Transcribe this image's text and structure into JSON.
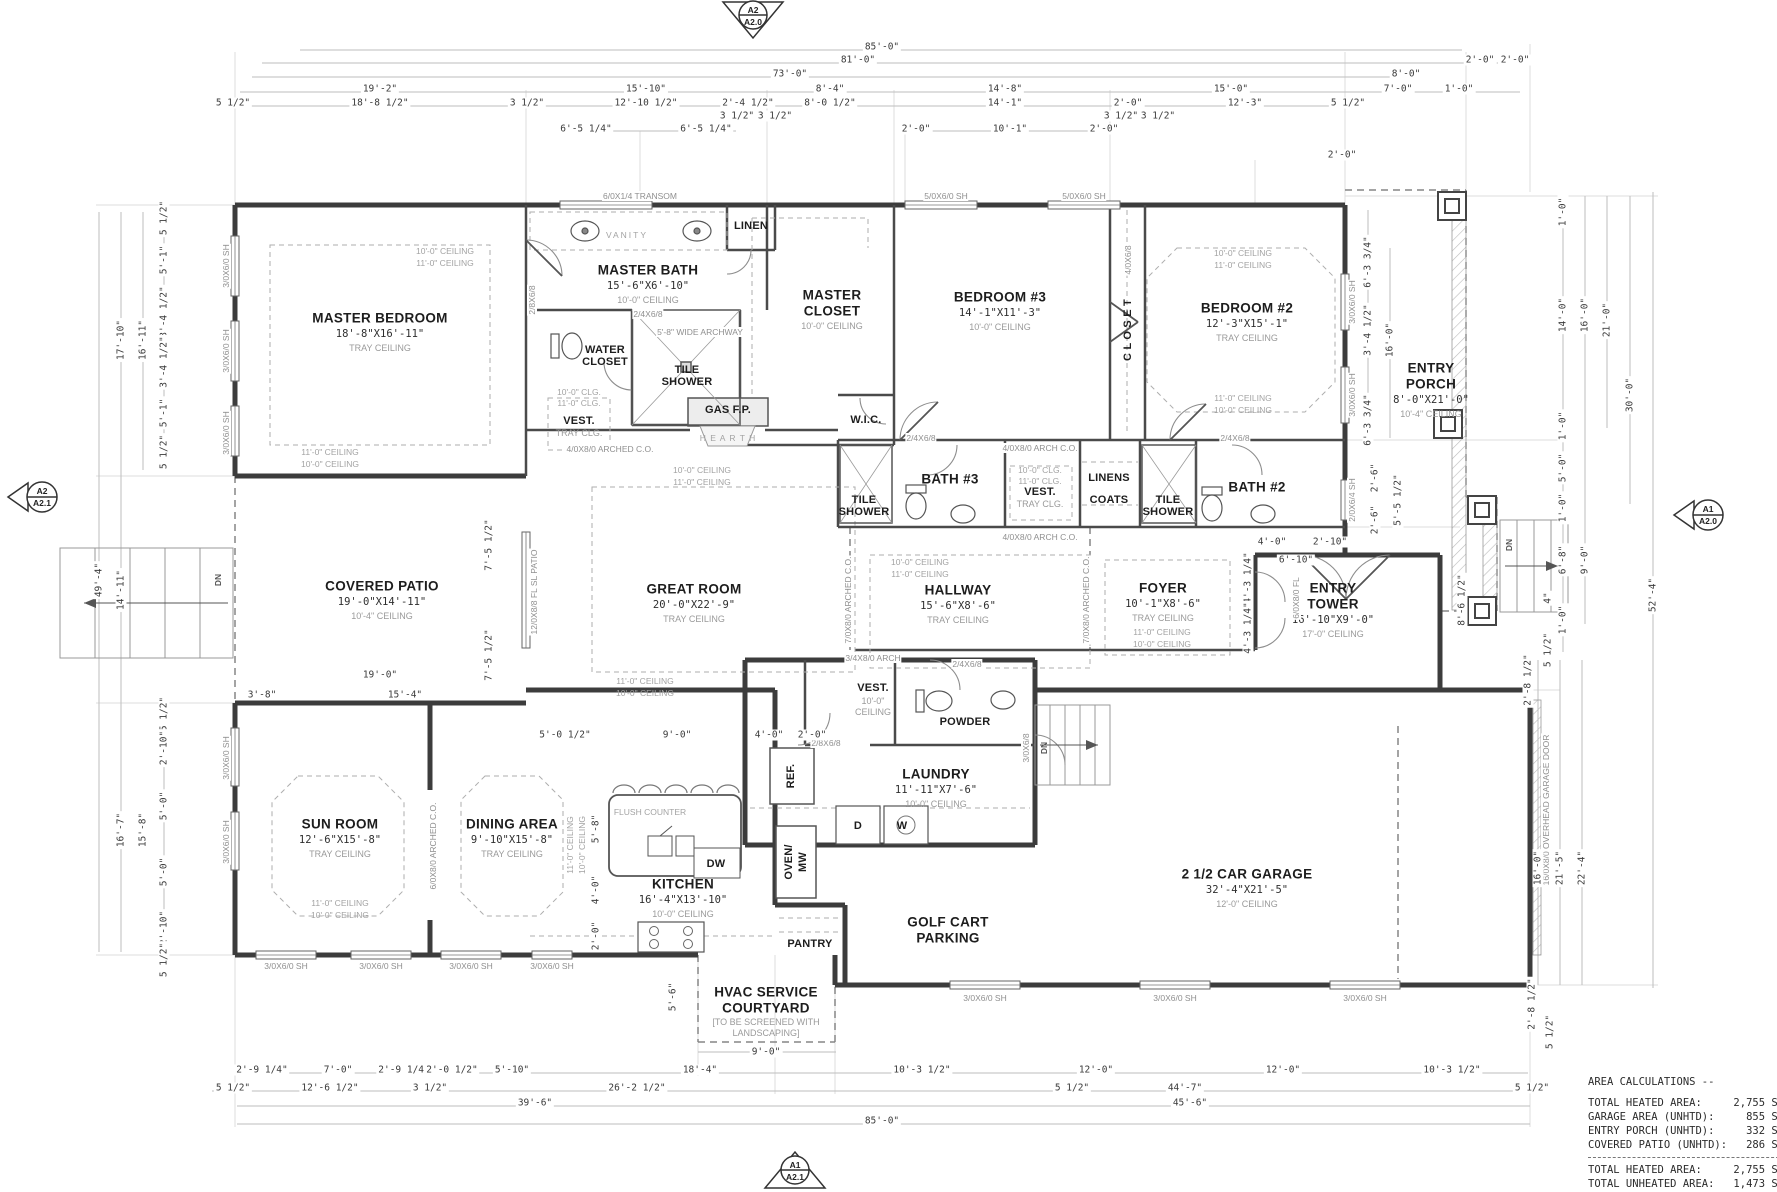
{
  "markers": {
    "top": {
      "code": "A2",
      "sheet": "A2.0"
    },
    "bottom": {
      "code": "A1",
      "sheet": "A2.1"
    },
    "left": {
      "code": "A2",
      "sheet": "A2.1"
    },
    "right": {
      "code": "A1",
      "sheet": "A2.0"
    }
  },
  "rooms": {
    "master_bedroom": {
      "name": "MASTER BEDROOM",
      "size": "18'-8\"X16'-11\"",
      "ceiling": "TRAY CEILING"
    },
    "master_bath": {
      "name": "MASTER BATH",
      "size": "15'-6\"X6'-10\"",
      "ceiling": "10'-0\" CEILING"
    },
    "master_closet": {
      "name": "MASTER",
      "name2": "CLOSET",
      "ceiling": "10'-0\" CEILING"
    },
    "bedroom3": {
      "name": "BEDROOM #3",
      "size": "14'-1\"X11'-3\"",
      "ceiling": "10'-0\" CEILING"
    },
    "bedroom2": {
      "name": "BEDROOM #2",
      "size": "12'-3\"X15'-1\"",
      "ceiling": "TRAY CEILING"
    },
    "entry_porch": {
      "name": "ENTRY",
      "name2": "PORCH",
      "size": "8'-0\"X21'-0\"",
      "ceiling": "10'-4\" CEILING"
    },
    "covered_patio": {
      "name": "COVERED PATIO",
      "size": "19'-0\"X14'-11\"",
      "ceiling": "10'-4\" CEILING"
    },
    "great_room": {
      "name": "GREAT ROOM",
      "size": "20'-0\"X22'-9\"",
      "ceiling": "TRAY CEILING"
    },
    "hallway": {
      "name": "HALLWAY",
      "size": "15'-6\"X8'-6\"",
      "ceiling": "TRAY CEILING"
    },
    "foyer": {
      "name": "FOYER",
      "size": "10'-1\"X8'-6\"",
      "ceiling": "TRAY CEILING"
    },
    "entry_tower": {
      "name": "ENTRY",
      "name2": "TOWER",
      "size": "16'-10\"X9'-0\"",
      "ceiling": "17'-0\" CEILING"
    },
    "bath3": {
      "name": "BATH #3"
    },
    "bath2": {
      "name": "BATH #2"
    },
    "vest_rear": {
      "name": "VEST.",
      "ceiling": "10'-0\"",
      "ceiling2": "CEILING"
    },
    "laundry": {
      "name": "LAUNDRY",
      "size": "11'-11\"X7'-6\"",
      "ceiling": "10'-0\" CEILING"
    },
    "sun_room": {
      "name": "SUN ROOM",
      "size": "12'-6\"X15'-8\"",
      "ceiling": "TRAY CEILING"
    },
    "dining": {
      "name": "DINING AREA",
      "size": "9'-10\"X15'-8\"",
      "ceiling": "TRAY CEILING"
    },
    "kitchen": {
      "name": "KITCHEN",
      "size": "16'-4\"X13'-10\"",
      "ceiling": "10'-0\" CEILING"
    },
    "garage": {
      "name": "2 1/2 CAR GARAGE",
      "size": "32'-4\"X21'-5\"",
      "ceiling": "12'-0\" CEILING"
    },
    "golf_cart": {
      "name": "GOLF CART",
      "name2": "PARKING"
    },
    "hvac": {
      "name": "HVAC SERVICE",
      "name2": "COURTYARD",
      "note1": "[TO BE SCREENED WITH",
      "note2": "LANDSCAPING]"
    }
  },
  "labels": {
    "vanity": "VANITY",
    "linen": "LINEN",
    "linens": "LINENS",
    "coats": "COATS",
    "wic": "W.I.C.",
    "gas_fp": "GAS F.P.",
    "hearth": "H E A R T H",
    "powder": "POWDER",
    "pantry": "PANTRY",
    "ref": "REF.",
    "dw": "DW",
    "d": "D",
    "w": "W",
    "oven": "OVEN/",
    "mw": "MW",
    "flush_counter": "FLUSH COUNTER",
    "dn": "DN",
    "tile": "TILE",
    "shower": "SHOWER",
    "closet_v": "C L O S E T",
    "water": "WATER",
    "closet": "CLOSET",
    "vest": "VEST.",
    "tray_clg": "TRAY CLG."
  },
  "ceiling_notes": {
    "c10": "10'-0\" CEILING",
    "c11": "11'-0\" CEILING",
    "clg10": "10'-0\" CLG.",
    "clg11": "11'-0\" CLG."
  },
  "openings": [
    "6/0X1/4 TRANSOM",
    "5/0X6/0 SH",
    "5/0X6/0 SH",
    "3/0X6/0 SH",
    "3/0X6/0 SH",
    "3/0X6/0 SH",
    "3/0X6/0 SH",
    "3/0X6/0 SH",
    "3/0X6/0 SH",
    "3/0X6/0 SH",
    "3/0X6/0 SH",
    "3/0X6/0 SH",
    "3/0X6/0 SH",
    "3/0X6/0 SH",
    "3/0X6/0 SH",
    "3/0X6/0 SH",
    "3/0X6/0 SH",
    "2/0X6/4 SH",
    "16/0X8/0 OVERHEAD GARAGE DOOR",
    "12/0X8/8 FL SL PATIO",
    "5'-8\" WIDE ARCHWAY",
    "4/0X8/0 ARCH C.O.",
    "4/0X8/0 ARCH C.O.",
    "4/0X8/0 ARCHED C.O.",
    "7/0X8/0 ARCHED C.O.",
    "7/0X8/0 ARCHED C.O.",
    "6/0X8/0 ARCHED C.O.",
    "6/0X8/0 FL",
    "3/4X8/0 ARCH",
    "2/4X6/8",
    "2/8X6/8",
    "3/0X6/8",
    "2/4X6/8",
    "2/4X6/8",
    "4/0X6/8",
    "2/4X6/8",
    "2/8X6/8"
  ],
  "dims": {
    "top": [
      "85'-0\"",
      "81'-0\"",
      "73'-0\"",
      "19'-2\"",
      "15'-10\"",
      "8'-4\"",
      "14'-8\"",
      "15'-0\"",
      "8'-0\"",
      "7'-0\"",
      "1'-0\"",
      "2'-0\"",
      "2'-0\"",
      "5 1/2\"",
      "18'-8 1/2\"",
      "3 1/2\"",
      "12'-10 1/2\"",
      "2'-4 1/2\"",
      "8'-0 1/2\"",
      "14'-1\"",
      "2'-0\"",
      "12'-3\"",
      "5 1/2\"",
      "6'-5 1/4\"",
      "6'-5 1/4\"",
      "3 1/2\"",
      "3 1/2\"",
      "2'-0\"",
      "10'-1\"",
      "2'-0\"",
      "3 1/2\"",
      "3 1/2\"",
      "2'-0\""
    ],
    "bottom": [
      "2'-9 1/4\"",
      "7'-0\"",
      "2'-9 1/4\"",
      "2'-0 1/2\"",
      "5'-10\"",
      "18'-4\"",
      "10'-3 1/2\"",
      "12'-0\"",
      "12'-0\"",
      "10'-3 1/2\"",
      "5 1/2\"",
      "12'-6 1/2\"",
      "3 1/2\"",
      "26'-2 1/2\"",
      "5 1/2\"",
      "44'-7\"",
      "5 1/2\"",
      "39'-6\"",
      "45'-6\"",
      "85'-0\"",
      "9'-0\""
    ],
    "left": [
      "49'-4\"",
      "17'-10\"",
      "16'-11\"",
      "14'-11\"",
      "16'-7\"",
      "15'-8\"",
      "5 1/2\"",
      "5'-1\"",
      "3'-4 1/2\"",
      "3'-4 1/2\"",
      "5'-1\"",
      "5 1/2\"",
      "5 1/2\"",
      "2'-10\"",
      "5'-0\"",
      "5'-0\"",
      "2'-10\"",
      "5 1/2\""
    ],
    "right": [
      "1'-0\"",
      "14'-0\"",
      "16'-0\"",
      "21'-0\"",
      "30'-0\"",
      "52'-4\"",
      "1'-0\"",
      "5'-0\"",
      "1'-0\"",
      "6'-8\"",
      "9'-0\"",
      "4\"",
      "1'-0\"",
      "5 1/2\"",
      "2'-8 1/2\"",
      "16'-0\"",
      "21'-5\"",
      "22'-4\"",
      "2'-8 1/2\"",
      "5 1/2\"",
      "6'-3 3/4\"",
      "3'-4 1/2\"",
      "16'-0\"",
      "6'-3 3/4\"",
      "2'-6\"",
      "2'-6\"",
      "5'-5 1/2\"",
      "8'-6 1/2\""
    ],
    "interior": [
      "7'-5 1/2\"",
      "7'-5 1/2\"",
      "19'-0\"",
      "3'-8\"",
      "15'-4\"",
      "5'-0 1/2\"",
      "9'-0\"",
      "4'-0\"",
      "2'-0\"",
      "5'-8\"",
      "4'-0\"",
      "2'-0\"",
      "5'-6\"",
      "4'-0\"",
      "2'-10\"",
      "6'-10\"",
      "4'-3 1/4\"",
      "4'-3 1/4\""
    ]
  },
  "area_calculations": {
    "title": "AREA CALCULATIONS --",
    "rows": [
      {
        "label": "TOTAL HEATED AREA:",
        "value": "2,755 SF"
      },
      {
        "label": "GARAGE AREA (UNHTD):",
        "value": "855 SF"
      },
      {
        "label": "ENTRY PORCH (UNHTD):",
        "value": "332 SF"
      },
      {
        "label": "COVERED PATIO (UNHTD):",
        "value": "286 SF"
      }
    ],
    "totals": [
      {
        "label": "TOTAL HEATED AREA:",
        "value": "2,755 SF"
      },
      {
        "label": "TOTAL UNHEATED AREA:",
        "value": "1,473 SF"
      },
      {
        "label": "TOTAL UNDER ROOF:",
        "value": "4,229 SF"
      }
    ]
  }
}
